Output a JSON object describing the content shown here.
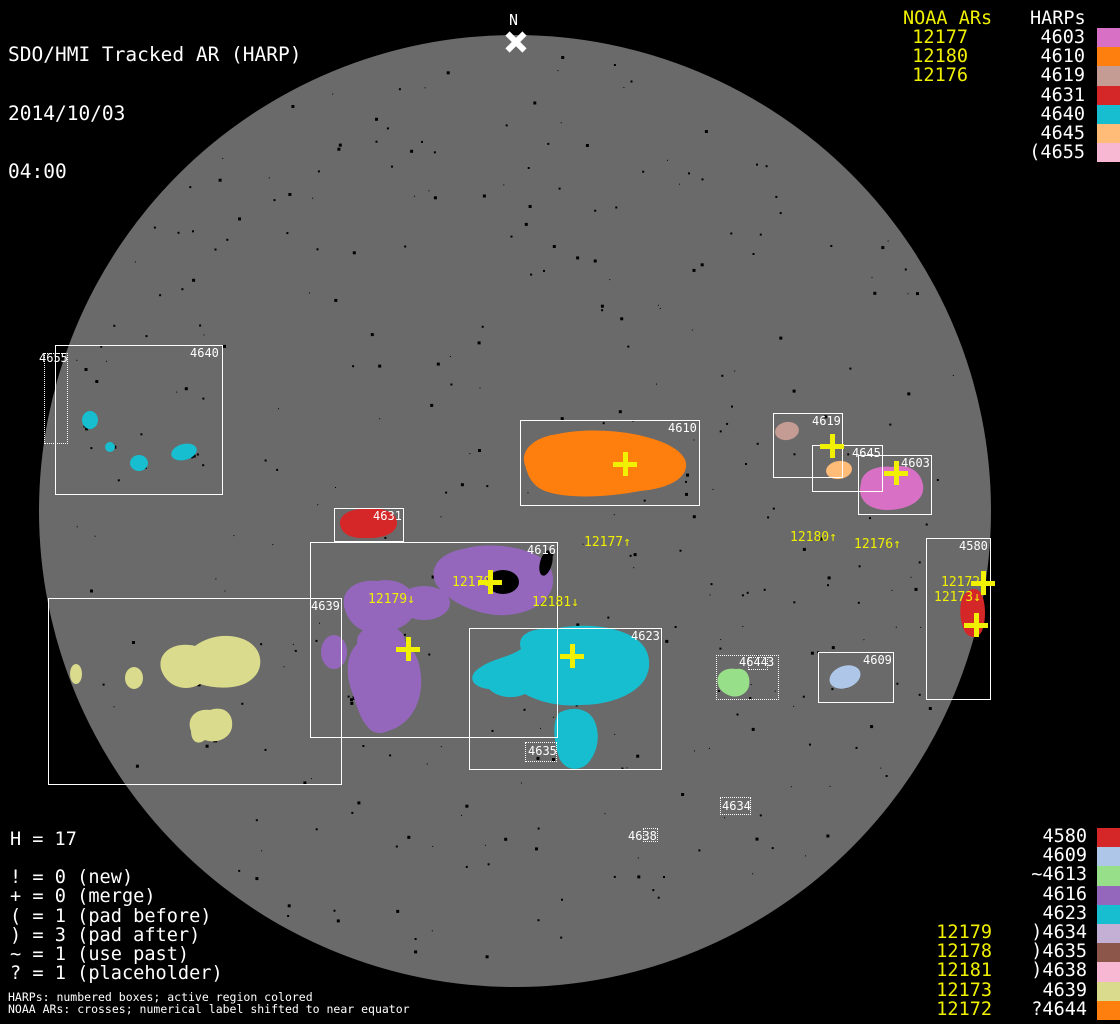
{
  "title": {
    "line1": "SDO/HMI Tracked AR (HARP)",
    "date": "2014/10/03",
    "time": "04:00"
  },
  "pole_label": "N",
  "colors": {
    "background": "#000000",
    "disk": "#6a6a6a",
    "noaa_text": "#f0f000",
    "harp_text": "#ffffff"
  },
  "top_right": {
    "noaa_header": "NOAA ARs",
    "harp_header": "HARPs",
    "noaa_list": [
      "12177",
      "12180",
      "12176"
    ],
    "harp_list": [
      {
        "label": "4603",
        "color": "#d870c6"
      },
      {
        "label": "4610",
        "color": "#ff7f0e"
      },
      {
        "label": "4619",
        "color": "#c49c94"
      },
      {
        "label": "4631",
        "color": "#d62728"
      },
      {
        "label": "4640",
        "color": "#17becf"
      },
      {
        "label": "4645",
        "color": "#ffbb78"
      },
      {
        "label": "(4655",
        "color": "#f7b6d2"
      }
    ]
  },
  "bottom_right": {
    "noaa_list": [
      "12179",
      "12178",
      "12181",
      "12173",
      "12172"
    ],
    "harp_list": [
      {
        "label": "4580",
        "color": "#d62728"
      },
      {
        "label": "4609",
        "color": "#aec7e8"
      },
      {
        "label": "~4613",
        "color": "#98df8a"
      },
      {
        "label": "4616",
        "color": "#9467bd"
      },
      {
        "label": "4623",
        "color": "#17becf"
      },
      {
        "label": ")4634",
        "color": "#c5b0d5"
      },
      {
        "label": ")4635",
        "color": "#8c564b"
      },
      {
        "label": ")4638",
        "color": "#f7b6d2"
      },
      {
        "label": "4639",
        "color": "#dbdb8d"
      },
      {
        "label": "?4644",
        "color": "#ff7f0e"
      }
    ]
  },
  "bottom_left": {
    "h_count": "H = 17",
    "legend": [
      "! = 0 (new)",
      "+ = 0 (merge)",
      "( = 1 (pad before)",
      ") = 3 (pad after)",
      "~ = 1 (use past)",
      "? = 1 (placeholder)"
    ],
    "footnote1": "HARPs: numbered boxes; active region colored",
    "footnote2": "NOAA ARs: crosses; numerical label shifted to near equator"
  },
  "regions": {
    "4603": "#d870c6",
    "4610": "#ff7f0e",
    "4619": "#c49c94",
    "4631": "#d62728",
    "4640": "#17becf",
    "4645": "#ffbb78",
    "4580": "#d62728",
    "4609": "#aec7e8",
    "4613": "#98df8a",
    "4616": "#9467bd",
    "4623": "#17becf",
    "4639": "#dbdb8d"
  },
  "chart_data": {
    "type": "solar-disk-map",
    "title": "SDO/HMI Tracked AR (HARP)",
    "datetime": "2014/10/03 04:00",
    "disk": {
      "cx": 515,
      "cy": 511,
      "r": 476
    },
    "harp_boxes": [
      {
        "harp": "4640",
        "x": 55,
        "y": 345,
        "w": 168,
        "h": 150,
        "border": "solid",
        "label_x": 190,
        "label_y": 347
      },
      {
        "harp": "4655",
        "x": 44,
        "y": 353,
        "w": 24,
        "h": 91,
        "border": "dotted",
        "label_x": 39,
        "label_y": 352
      },
      {
        "harp": "4610",
        "x": 520,
        "y": 420,
        "w": 180,
        "h": 86,
        "border": "solid",
        "label_x": 668,
        "label_y": 422
      },
      {
        "harp": "4619",
        "x": 773,
        "y": 413,
        "w": 70,
        "h": 65,
        "border": "solid",
        "label_x": 812,
        "label_y": 415
      },
      {
        "harp": "4645",
        "x": 812,
        "y": 445,
        "w": 71,
        "h": 47,
        "border": "solid",
        "label_x": 852,
        "label_y": 447
      },
      {
        "harp": "4603",
        "x": 858,
        "y": 455,
        "w": 74,
        "h": 60,
        "border": "solid",
        "label_x": 901,
        "label_y": 457
      },
      {
        "harp": "4631",
        "x": 334,
        "y": 508,
        "w": 70,
        "h": 34,
        "border": "solid",
        "label_x": 373,
        "label_y": 510
      },
      {
        "harp": "4616",
        "x": 310,
        "y": 542,
        "w": 248,
        "h": 196,
        "border": "solid",
        "label_x": 527,
        "label_y": 544
      },
      {
        "harp": "4639",
        "x": 48,
        "y": 598,
        "w": 294,
        "h": 187,
        "border": "solid",
        "label_x": 311,
        "label_y": 600
      },
      {
        "harp": "4623",
        "x": 469,
        "y": 628,
        "w": 193,
        "h": 142,
        "border": "solid",
        "label_x": 631,
        "label_y": 630
      },
      {
        "harp": "4580",
        "x": 926,
        "y": 538,
        "w": 65,
        "h": 162,
        "border": "solid",
        "label_x": 959,
        "label_y": 540
      },
      {
        "harp": "4609",
        "x": 818,
        "y": 652,
        "w": 76,
        "h": 51,
        "border": "solid",
        "label_x": 863,
        "label_y": 654
      },
      {
        "harp": "4613",
        "x": 716,
        "y": 655,
        "w": 63,
        "h": 45,
        "border": "dotted",
        "label_x": 9999,
        "label_y": 9999
      },
      {
        "harp": "4644",
        "x": 748,
        "y": 657,
        "w": 20,
        "h": 13,
        "border": "dotted",
        "label_x": 739,
        "label_y": 656
      },
      {
        "harp": "4635",
        "x": 525,
        "y": 742,
        "w": 32,
        "h": 20,
        "border": "dotted",
        "label_x": 528,
        "label_y": 745
      },
      {
        "harp": "4634",
        "x": 720,
        "y": 797,
        "w": 31,
        "h": 18,
        "border": "dotted",
        "label_x": 722,
        "label_y": 800
      },
      {
        "harp": "4638",
        "x": 643,
        "y": 828,
        "w": 15,
        "h": 14,
        "border": "dotted",
        "label_x": 628,
        "label_y": 830
      }
    ],
    "extra_texts": [
      {
        "text": "3",
        "x": 767,
        "y": 656
      }
    ],
    "noaa_crosses": [
      {
        "noaa": "12177",
        "x": 625,
        "y": 464
      },
      {
        "noaa": "12180",
        "x": 832,
        "y": 446
      },
      {
        "noaa": "12176",
        "x": 896,
        "y": 473
      },
      {
        "noaa": "12178",
        "x": 490,
        "y": 582
      },
      {
        "noaa": "12179",
        "x": 408,
        "y": 649
      },
      {
        "noaa": "12181",
        "x": 572,
        "y": 656
      },
      {
        "noaa": "12172",
        "x": 983,
        "y": 583
      },
      {
        "noaa": "12173",
        "x": 976,
        "y": 625
      }
    ],
    "noaa_disk_labels": [
      {
        "text": "12177↑",
        "x": 584,
        "y": 536
      },
      {
        "text": "12180↑",
        "x": 790,
        "y": 531
      },
      {
        "text": "12176↑",
        "x": 854,
        "y": 538
      },
      {
        "text": "12178",
        "x": 452,
        "y": 576
      },
      {
        "text": "12179↓",
        "x": 368,
        "y": 593
      },
      {
        "text": "12181↓",
        "x": 532,
        "y": 596
      },
      {
        "text": "12172",
        "x": 941,
        "y": 576
      },
      {
        "text": "12173↓",
        "x": 934,
        "y": 591
      }
    ]
  }
}
